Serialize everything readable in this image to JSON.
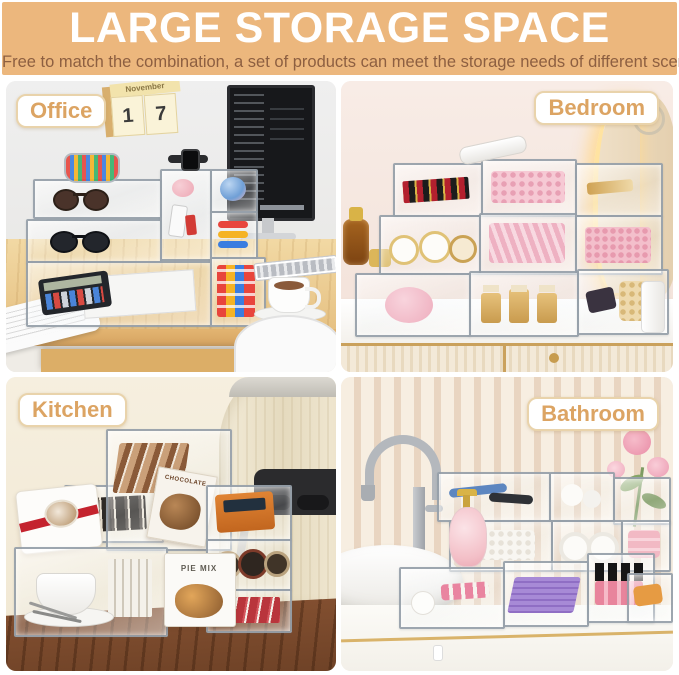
{
  "header": {
    "title": "LARGE STORAGE SPACE",
    "subtitle": "Free to match the combination, a set of products can meet the storage needs of different scenes!"
  },
  "theme": {
    "banner_bg": "#ecb77d",
    "banner_title_color": "#ffffff",
    "banner_subtitle_color": "#8d5f41",
    "label_text_color": "#dca463",
    "label_border_color": "#e9d3ab",
    "label_bg": "#ffffff"
  },
  "scenes": [
    {
      "id": "office",
      "label": "Office",
      "calendar": {
        "month": "November",
        "day_left": "1",
        "day_right": "7"
      }
    },
    {
      "id": "bedroom",
      "label": "Bedroom"
    },
    {
      "id": "kitchen",
      "label": "Kitchen",
      "packages": {
        "chocolate_box": "CHOCOLATE",
        "pie_box": "PIE MIX"
      }
    },
    {
      "id": "bathroom",
      "label": "Bathroom"
    }
  ]
}
